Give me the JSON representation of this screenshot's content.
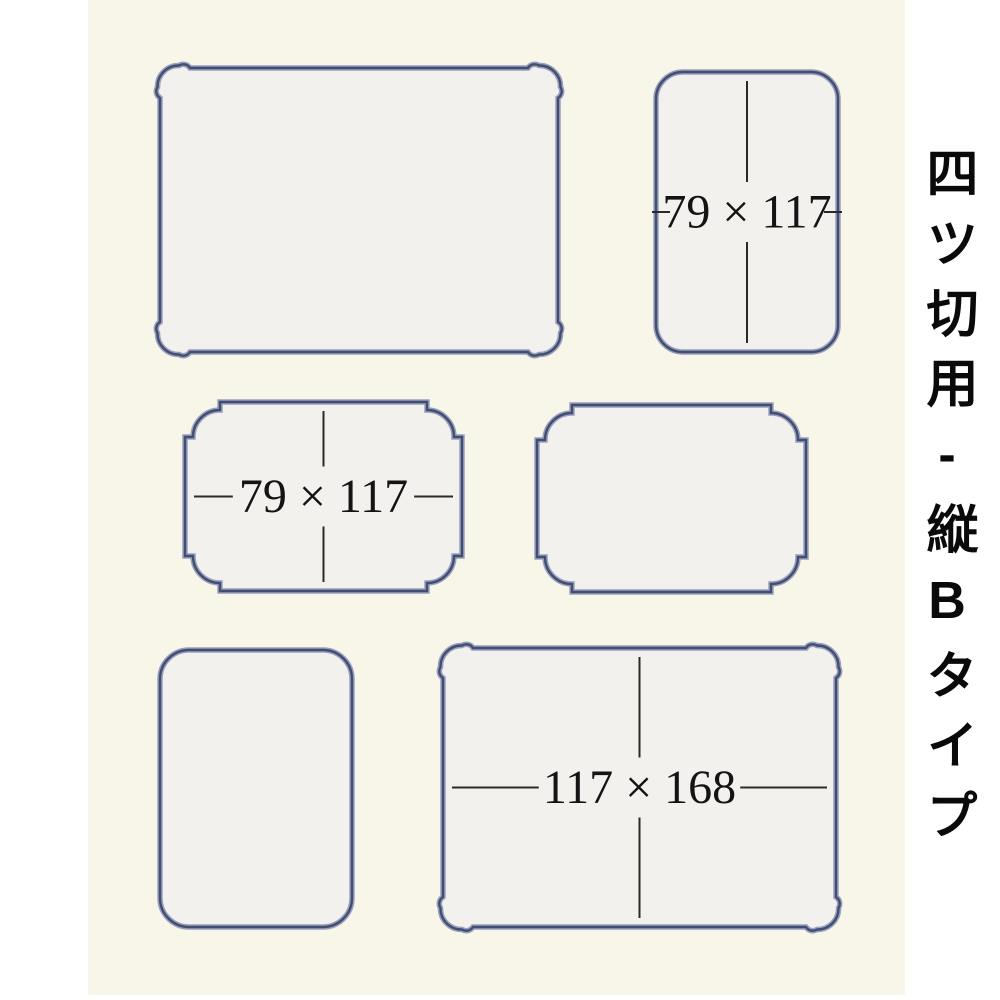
{
  "page": {
    "background": "#ffffff"
  },
  "side_label": {
    "text": "四ツ切用-縦Bタイプ"
  },
  "board": {
    "x": 88,
    "y": 0,
    "width": 817,
    "height": 995,
    "surface_color": "#f8f6e9",
    "opening_fill": "#f2f1ee",
    "border_color": "#424d6f",
    "border_bevel_color": "#98a0bd",
    "dim_line_color": "#2a2a2a",
    "label_color": "#141414"
  },
  "openings": [
    {
      "id": "top-left",
      "style": "french",
      "x": 160,
      "y": 68,
      "width": 398,
      "height": 284
    },
    {
      "id": "top-right",
      "style": "scallop",
      "x": 656,
      "y": 72,
      "width": 182,
      "height": 280,
      "corner_radius": 27,
      "dim": {
        "label": "79 × 117",
        "vertical": true,
        "horizontal": "stubs"
      }
    },
    {
      "id": "middle-left",
      "style": "step",
      "x": 185,
      "y": 402,
      "width": 277,
      "height": 189,
      "dim": {
        "label": "79 × 117",
        "vertical": true,
        "horizontal": "full"
      }
    },
    {
      "id": "middle-right",
      "style": "step",
      "x": 537,
      "y": 405,
      "width": 269,
      "height": 187
    },
    {
      "id": "bottom-left",
      "style": "scallop",
      "x": 160,
      "y": 650,
      "width": 192,
      "height": 277,
      "corner_radius": 29
    },
    {
      "id": "bottom-right",
      "style": "french",
      "x": 443,
      "y": 648,
      "width": 393,
      "height": 279,
      "dim": {
        "label": "117 × 168",
        "vertical": true,
        "horizontal": "full"
      }
    }
  ]
}
